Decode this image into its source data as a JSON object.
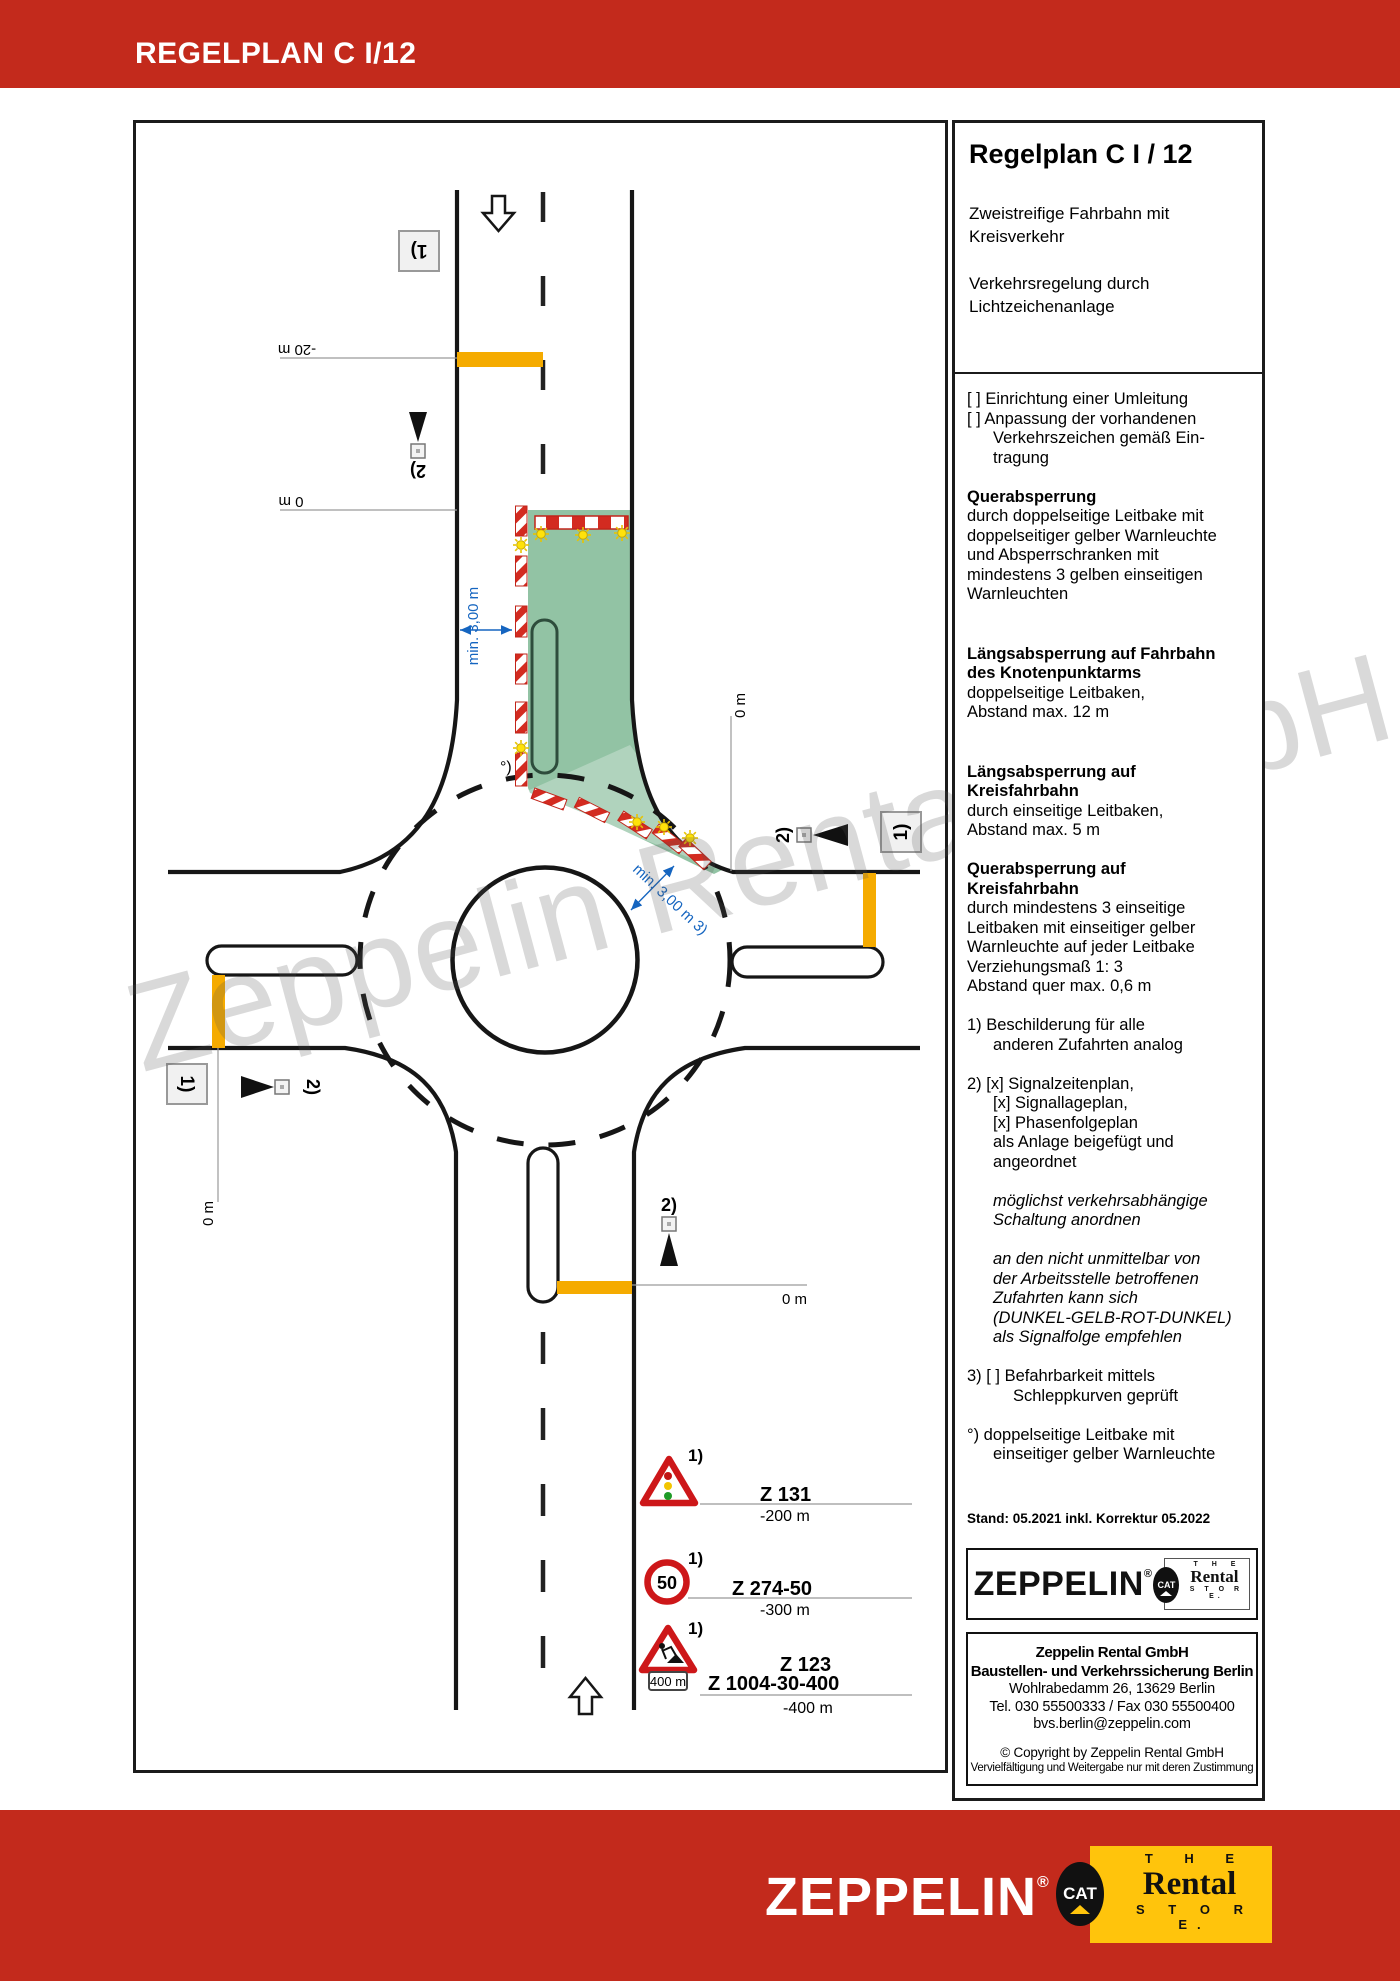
{
  "header": {
    "title": "REGELPLAN C I/12"
  },
  "watermark": "Zeppelin Rental GmbH",
  "panel": {
    "title": "Regelplan C I / 12",
    "subtitle1": "Zweistreifige Fahrbahn mit Kreisverkehr",
    "subtitle2": "Verkehrsregelung durch Lichtzeichenanlage",
    "body": [
      {
        "t": "[  ] Einrichtung einer Umleitung",
        "c": ""
      },
      {
        "t": "[  ] Anpassung der vorhandenen",
        "c": ""
      },
      {
        "t": "Verkehrszeichen gemäß Ein-",
        "c": "ind"
      },
      {
        "t": "tragung",
        "c": "ind"
      },
      {
        "t": "",
        "c": "gap"
      },
      {
        "t": "Querabsperrung",
        "c": "b"
      },
      {
        "t": "durch doppelseitige Leitbake mit",
        "c": ""
      },
      {
        "t": "doppelseitiger gelber Warnleuchte",
        "c": ""
      },
      {
        "t": "und Absperrschranken mit",
        "c": ""
      },
      {
        "t": "mindestens 3 gelben einseitigen",
        "c": ""
      },
      {
        "t": "Warnleuchten",
        "c": ""
      },
      {
        "t": "",
        "c": "gap2"
      },
      {
        "t": "Längsabsperrung auf Fahrbahn",
        "c": "b"
      },
      {
        "t": "des Knotenpunktarms",
        "c": "b"
      },
      {
        "t": "doppelseitige Leitbaken,",
        "c": ""
      },
      {
        "t": "Abstand max. 12 m",
        "c": ""
      },
      {
        "t": "",
        "c": "gap2"
      },
      {
        "t": "Längsabsperrung auf",
        "c": "b"
      },
      {
        "t": "Kreisfahrbahn",
        "c": "b"
      },
      {
        "t": "durch einseitige Leitbaken,",
        "c": ""
      },
      {
        "t": "Abstand max. 5 m",
        "c": ""
      },
      {
        "t": "",
        "c": "gap"
      },
      {
        "t": "Querabsperrung auf",
        "c": "b"
      },
      {
        "t": "Kreisfahrbahn",
        "c": "b"
      },
      {
        "t": "durch mindestens 3 einseitige",
        "c": ""
      },
      {
        "t": "Leitbaken mit einseitiger gelber",
        "c": ""
      },
      {
        "t": "Warnleuchte auf jeder Leitbake",
        "c": ""
      },
      {
        "t": "Verziehungsmaß 1: 3",
        "c": ""
      },
      {
        "t": "Abstand quer max. 0,6 m",
        "c": ""
      },
      {
        "t": "",
        "c": "gap"
      },
      {
        "t": "1) Beschilderung für alle",
        "c": ""
      },
      {
        "t": "anderen Zufahrten analog",
        "c": "ind"
      },
      {
        "t": "",
        "c": "gap"
      },
      {
        "t": "2) [x] Signalzeitenplan,",
        "c": ""
      },
      {
        "t": "[x] Signallageplan,",
        "c": "ind"
      },
      {
        "t": "[x] Phasenfolgeplan",
        "c": "ind"
      },
      {
        "t": "als Anlage beigefügt und",
        "c": "ind"
      },
      {
        "t": "angeordnet",
        "c": "ind"
      },
      {
        "t": "",
        "c": "gap"
      },
      {
        "t": "möglichst verkehrsabhängige",
        "c": "i ind"
      },
      {
        "t": "Schaltung anordnen",
        "c": "i ind"
      },
      {
        "t": "",
        "c": "gap"
      },
      {
        "t": "an den nicht unmittelbar von",
        "c": "i ind"
      },
      {
        "t": "der Arbeitsstelle betroffenen",
        "c": "i ind"
      },
      {
        "t": "Zufahrten kann sich",
        "c": "i ind"
      },
      {
        "t": "(DUNKEL-GELB-ROT-DUNKEL)",
        "c": "i ind"
      },
      {
        "t": "als Signalfolge empfehlen",
        "c": "i ind"
      },
      {
        "t": "",
        "c": "gap"
      },
      {
        "t": "3) [  ] Befahrbarkeit mittels",
        "c": ""
      },
      {
        "t": "Schleppkurven geprüft",
        "c": "ind2"
      },
      {
        "t": "",
        "c": "gap"
      },
      {
        "t": "°) doppelseitige Leitbake mit",
        "c": ""
      },
      {
        "t": "einseitiger gelber Warnleuchte",
        "c": "ind"
      }
    ],
    "stand": "Stand: 05.2021 inkl. Korrektur 05.2022",
    "address": [
      {
        "t": "Zeppelin Rental GmbH",
        "c": "ab"
      },
      {
        "t": "Baustellen- und Verkehrssicherung Berlin",
        "c": "ab"
      },
      {
        "t": "Wohlrabedamm 26, 13629 Berlin",
        "c": "an"
      },
      {
        "t": "Tel. 030 55500333 / Fax 030 55500400",
        "c": "an"
      },
      {
        "t": "bvs.berlin@zeppelin.com",
        "c": "an"
      },
      {
        "t": "",
        "c": "ag"
      },
      {
        "t": "© Copyright by Zeppelin Rental GmbH",
        "c": "ac"
      },
      {
        "t": "Vervielfältigung und Weitergabe nur mit deren Zustimmung",
        "c": "ac2"
      }
    ]
  },
  "logos": {
    "zeppelin": "ZEPPELIN",
    "reg": "®",
    "cat": {
      "word": "CAT",
      "the": "T H E",
      "rental": "Rental",
      "store": "S T O R E."
    }
  },
  "diagram": {
    "note1": "1)",
    "note2": "2)",
    "note_deg": "°)",
    "dim_minus20": "-20 m",
    "dim_zero": "0 m",
    "dim_min300": "min. 3,00 m",
    "dim_min300_3": "min. 3,00 m 3)",
    "speed50": "50",
    "z131": "Z  131",
    "z131_dist": "-200 m",
    "z274": "Z  274-50",
    "z274_dist": "-300 m",
    "z123": "Z  123",
    "z1004": "Z  1004-30-400",
    "z1004_dist": "-400 m",
    "bake400": "400 m",
    "colors": {
      "brand_red": "#c32a1c",
      "cat_yellow": "#ffc40c",
      "barrier_orange": "#f5ab00",
      "work_area_green": "#92c3a4",
      "dimension_blue": "#1565c0",
      "sign_red": "#cd1719",
      "warnlight_yellow": "#ffe20a"
    }
  }
}
